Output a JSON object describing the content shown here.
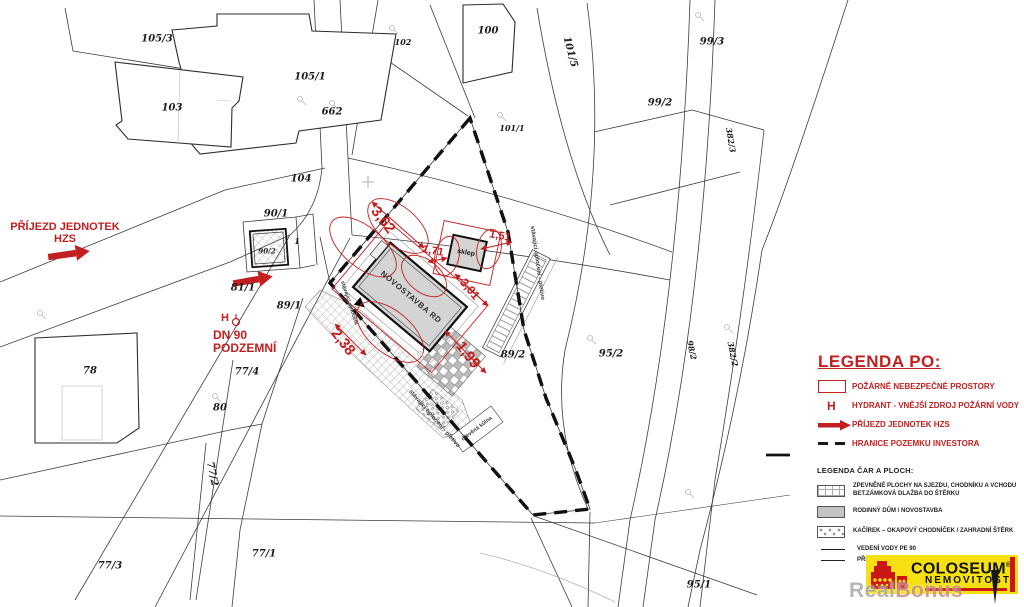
{
  "red_notes": {
    "prijezd_line1": "PŘÍJEZD JEDNOTEK",
    "prijezd_line2": "HZS",
    "hydrant": "H",
    "dn_line1": "DN 90",
    "dn_line2": "PODZEMNÍ"
  },
  "dimensions": [
    {
      "label": "3,62",
      "x": 383,
      "y": 220,
      "rot": 52,
      "size": 15
    },
    {
      "label": "1,71",
      "x": 433,
      "y": 251,
      "rot": 10,
      "size": 11
    },
    {
      "label": "1,51",
      "x": 500,
      "y": 236,
      "rot": 10,
      "size": 11
    },
    {
      "label": "3,01",
      "x": 470,
      "y": 289,
      "rot": 50,
      "size": 12
    },
    {
      "label": "2,38",
      "x": 343,
      "y": 342,
      "rot": 52,
      "size": 15
    },
    {
      "label": "1,99",
      "x": 468,
      "y": 355,
      "rot": 52,
      "size": 15
    }
  ],
  "parcels": [
    {
      "label": "105/3",
      "x": 157,
      "y": 39
    },
    {
      "label": "105/1",
      "x": 310,
      "y": 77
    },
    {
      "label": "103",
      "x": 172,
      "y": 108
    },
    {
      "label": "662",
      "x": 332,
      "y": 112,
      "size": 10
    },
    {
      "label": "104",
      "x": 301,
      "y": 179
    },
    {
      "label": "102",
      "x": 403,
      "y": 42,
      "size": 8
    },
    {
      "label": "100",
      "x": 488,
      "y": 31
    },
    {
      "label": "101/5",
      "x": 570,
      "y": 52,
      "rot": 75
    },
    {
      "label": "101/1",
      "x": 512,
      "y": 128,
      "size": 8
    },
    {
      "label": "99/3",
      "x": 712,
      "y": 42
    },
    {
      "label": "99/2",
      "x": 660,
      "y": 103
    },
    {
      "label": "382/3",
      "x": 731,
      "y": 140,
      "rot": 80,
      "size": 8
    },
    {
      "label": "98/2",
      "x": 692,
      "y": 350,
      "rot": 78,
      "size": 8
    },
    {
      "label": "382/2",
      "x": 733,
      "y": 354,
      "rot": 78,
      "size": 8
    },
    {
      "label": "95/2",
      "x": 611,
      "y": 354
    },
    {
      "label": "95/1",
      "x": 699,
      "y": 585
    },
    {
      "label": "89/2",
      "x": 513,
      "y": 355
    },
    {
      "label": "90/1",
      "x": 276,
      "y": 214
    },
    {
      "label": "90/2",
      "x": 267,
      "y": 251,
      "size": 7
    },
    {
      "label": "1",
      "x": 297,
      "y": 241,
      "size": 8
    },
    {
      "label": "81/1",
      "x": 243,
      "y": 288
    },
    {
      "label": "89/1",
      "x": 289,
      "y": 306
    },
    {
      "label": "78",
      "x": 90,
      "y": 371
    },
    {
      "label": "77/4",
      "x": 247,
      "y": 372
    },
    {
      "label": "80",
      "x": 220,
      "y": 408
    },
    {
      "label": "77/2",
      "x": 212,
      "y": 474,
      "rot": 78
    },
    {
      "label": "77/1",
      "x": 264,
      "y": 554
    },
    {
      "label": "77/3",
      "x": 110,
      "y": 566
    }
  ],
  "plan_labels": [
    {
      "text": "sklep",
      "x": 466,
      "y": 253,
      "rot": 10,
      "size": 7,
      "color": "#1b1b1b",
      "bold": true
    },
    {
      "text": "NOVOSTAVBA RD",
      "x": 411,
      "y": 297,
      "rot": 40,
      "size": 8,
      "color": "#2e2e2e",
      "ls": 0.6,
      "bold": true
    },
    {
      "text": "stávající oplocení - pletivo",
      "x": 434,
      "y": 419,
      "rot": 49,
      "size": 6,
      "color": "#3c3c3c"
    },
    {
      "text": "stávající oplocení - pletivo",
      "x": 537,
      "y": 263,
      "rot": 82,
      "size": 6,
      "color": "#3c3c3c"
    },
    {
      "text": "stávající oplocení",
      "x": 349,
      "y": 303,
      "rot": 72,
      "size": 5.5,
      "color": "#3c3c3c"
    },
    {
      "text": "dřevěná kůlna",
      "x": 477,
      "y": 429,
      "rot": -37,
      "size": 5.5,
      "color": "#3c3c3c"
    }
  ],
  "legend_po": {
    "title": "LEGENDA PO:",
    "hydrant_symbol": "H",
    "items": [
      "POŽÁRNĚ NEBEZPEČNÉ PROSTORY",
      "HYDRANT - VNĚJŠÍ ZDROJ POŽÁRNÍ VODY",
      "PŘÍJEZD JEDNOTEK HZS",
      "HRANICE POZEMKU INVESTORA"
    ]
  },
  "legend_plochy": {
    "title": "LEGENDA ČAR A PLOCH:",
    "item1_line1": "ZPEVNĚNÉ PLOCHY NA SJEZDU, CHODNÍKU A VCHODU",
    "item1_line2": "BET.ZÁMKOVÁ DLAŽBA DO ŠTĚRKU",
    "item2": "RODINNÝ DŮM / NOVOSTAVBA",
    "item3": "KAČÍREK – OKAPOVÝ CHODNÍČEK / ZAHRADNÍ ŠTĚRK",
    "item4": "VEDENÍ VODY PE 90",
    "item5": "PŘÍPOJKA VODY LPE DN 32"
  },
  "logo": {
    "brand": "COLOSEUM",
    "registered": "®",
    "subtitle": "NEMOVITOSTI"
  },
  "watermark": {
    "part1": "Real",
    "part2": "Bonus"
  },
  "colors": {
    "annotation_red": "#c22020",
    "logo_yellow": "#f6e011",
    "logo_red": "#cc1616",
    "building_gray": "#d4d4d4"
  }
}
